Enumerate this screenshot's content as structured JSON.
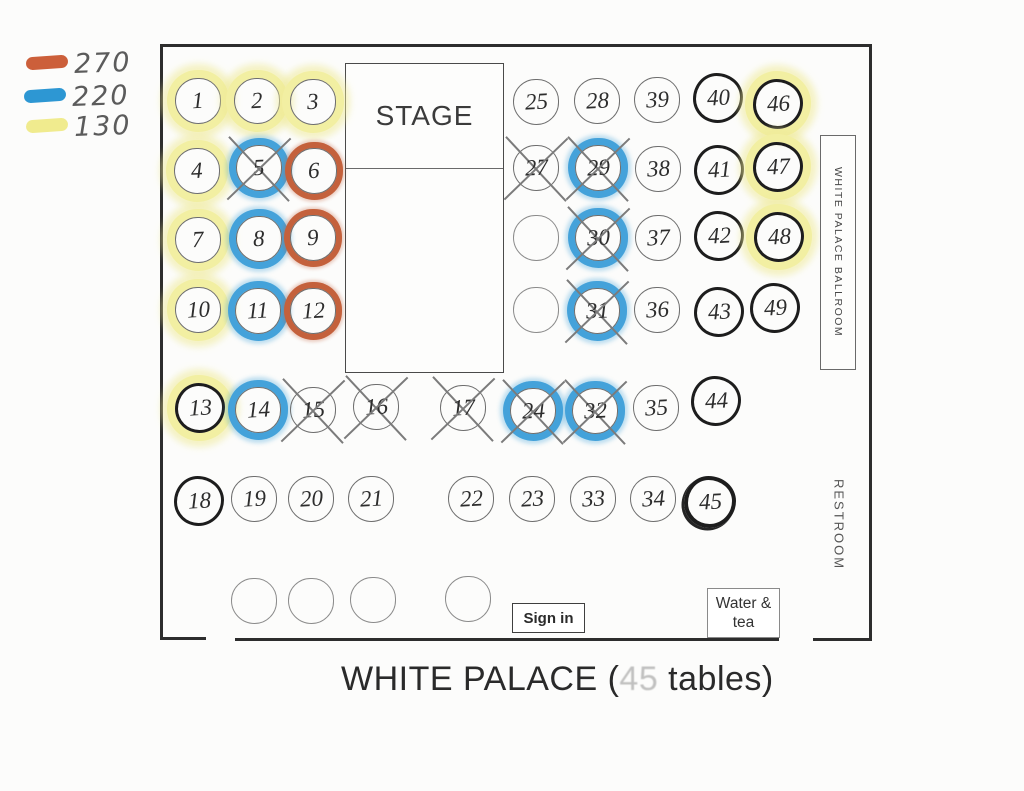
{
  "legend": {
    "items": [
      {
        "name": "orange-marker",
        "color": "#cc5f3a",
        "value": "270"
      },
      {
        "name": "blue-marker",
        "color": "#2d97d3",
        "value": "220"
      },
      {
        "name": "yellow-marker",
        "color": "#f0eb8e",
        "value": "130"
      }
    ]
  },
  "stage": {
    "label": "STAGE"
  },
  "signs": {
    "sign_in": "Sign in",
    "water_tea": "Water & tea",
    "wall_sign": "WHITE PALACE BALLROOM",
    "restroom": "RESTROOM"
  },
  "title": {
    "prefix": "WHITE PALACE (",
    "obscured_number": "45",
    "suffix": " tables)"
  },
  "tables": [
    {
      "n": "1",
      "x": 197,
      "y": 100,
      "hl": "yellow"
    },
    {
      "n": "2",
      "x": 256,
      "y": 100,
      "hl": "yellow"
    },
    {
      "n": "3",
      "x": 312,
      "y": 101,
      "hl": "yellow"
    },
    {
      "n": "4",
      "x": 196,
      "y": 170,
      "hl": "yellow"
    },
    {
      "n": "5",
      "x": 258,
      "y": 167,
      "hl": "blue",
      "crossed": true
    },
    {
      "n": "6",
      "x": 313,
      "y": 170,
      "hl": "orange"
    },
    {
      "n": "7",
      "x": 197,
      "y": 239,
      "hl": "yellow"
    },
    {
      "n": "8",
      "x": 258,
      "y": 238,
      "hl": "blue"
    },
    {
      "n": "9",
      "x": 312,
      "y": 237,
      "hl": "orange"
    },
    {
      "n": "10",
      "x": 197,
      "y": 309,
      "hl": "yellow"
    },
    {
      "n": "11",
      "x": 257,
      "y": 310,
      "hl": "blue"
    },
    {
      "n": "12",
      "x": 312,
      "y": 310,
      "hl": "orange"
    },
    {
      "n": "13",
      "x": 197,
      "y": 405,
      "hl": "yellow",
      "bold": true
    },
    {
      "n": "14",
      "x": 257,
      "y": 409,
      "hl": "blue"
    },
    {
      "n": "15",
      "x": 312,
      "y": 409,
      "crossed": true
    },
    {
      "n": "16",
      "x": 375,
      "y": 406,
      "crossed": true
    },
    {
      "n": "17",
      "x": 462,
      "y": 407,
      "crossed": true
    },
    {
      "n": "24",
      "x": 532,
      "y": 410,
      "hl": "blue",
      "crossed": true
    },
    {
      "n": "32",
      "x": 594,
      "y": 410,
      "hl": "blue",
      "crossed": true
    },
    {
      "n": "35",
      "x": 655,
      "y": 407
    },
    {
      "n": "44",
      "x": 713,
      "y": 398,
      "bold": true
    },
    {
      "n": "18",
      "x": 196,
      "y": 498,
      "bold": true
    },
    {
      "n": "19",
      "x": 253,
      "y": 498
    },
    {
      "n": "20",
      "x": 310,
      "y": 498
    },
    {
      "n": "21",
      "x": 370,
      "y": 498
    },
    {
      "n": "22",
      "x": 470,
      "y": 498
    },
    {
      "n": "23",
      "x": 531,
      "y": 498
    },
    {
      "n": "33",
      "x": 592,
      "y": 498
    },
    {
      "n": "34",
      "x": 652,
      "y": 498
    },
    {
      "n": "45",
      "x": 706,
      "y": 498,
      "bold": true,
      "extra": true
    },
    {
      "n": "25",
      "x": 535,
      "y": 101
    },
    {
      "n": "28",
      "x": 596,
      "y": 100
    },
    {
      "n": "39",
      "x": 656,
      "y": 99
    },
    {
      "n": "40",
      "x": 715,
      "y": 95,
      "bold": true
    },
    {
      "n": "46",
      "x": 775,
      "y": 101,
      "hl": "yellow",
      "bold": true
    },
    {
      "n": "27",
      "x": 535,
      "y": 167,
      "crossed": true
    },
    {
      "n": "29",
      "x": 597,
      "y": 167,
      "hl": "blue",
      "crossed": true
    },
    {
      "n": "38",
      "x": 657,
      "y": 168
    },
    {
      "n": "41",
      "x": 716,
      "y": 167,
      "bold": true
    },
    {
      "n": "47",
      "x": 775,
      "y": 164,
      "hl": "yellow",
      "bold": true
    },
    {
      "n": "",
      "x": 535,
      "y": 237
    },
    {
      "n": "30",
      "x": 597,
      "y": 237,
      "hl": "blue",
      "crossed": true
    },
    {
      "n": "37",
      "x": 657,
      "y": 237
    },
    {
      "n": "42",
      "x": 716,
      "y": 233,
      "bold": true
    },
    {
      "n": "48",
      "x": 776,
      "y": 234,
      "hl": "yellow",
      "bold": true
    },
    {
      "n": "",
      "x": 535,
      "y": 309
    },
    {
      "n": "31",
      "x": 596,
      "y": 310,
      "hl": "blue",
      "crossed": true
    },
    {
      "n": "36",
      "x": 656,
      "y": 309
    },
    {
      "n": "43",
      "x": 716,
      "y": 309,
      "bold": true
    },
    {
      "n": "49",
      "x": 772,
      "y": 305,
      "bold": true
    },
    {
      "n": "",
      "x": 253,
      "y": 600
    },
    {
      "n": "",
      "x": 310,
      "y": 600
    },
    {
      "n": "",
      "x": 372,
      "y": 599
    },
    {
      "n": "",
      "x": 467,
      "y": 598
    }
  ]
}
